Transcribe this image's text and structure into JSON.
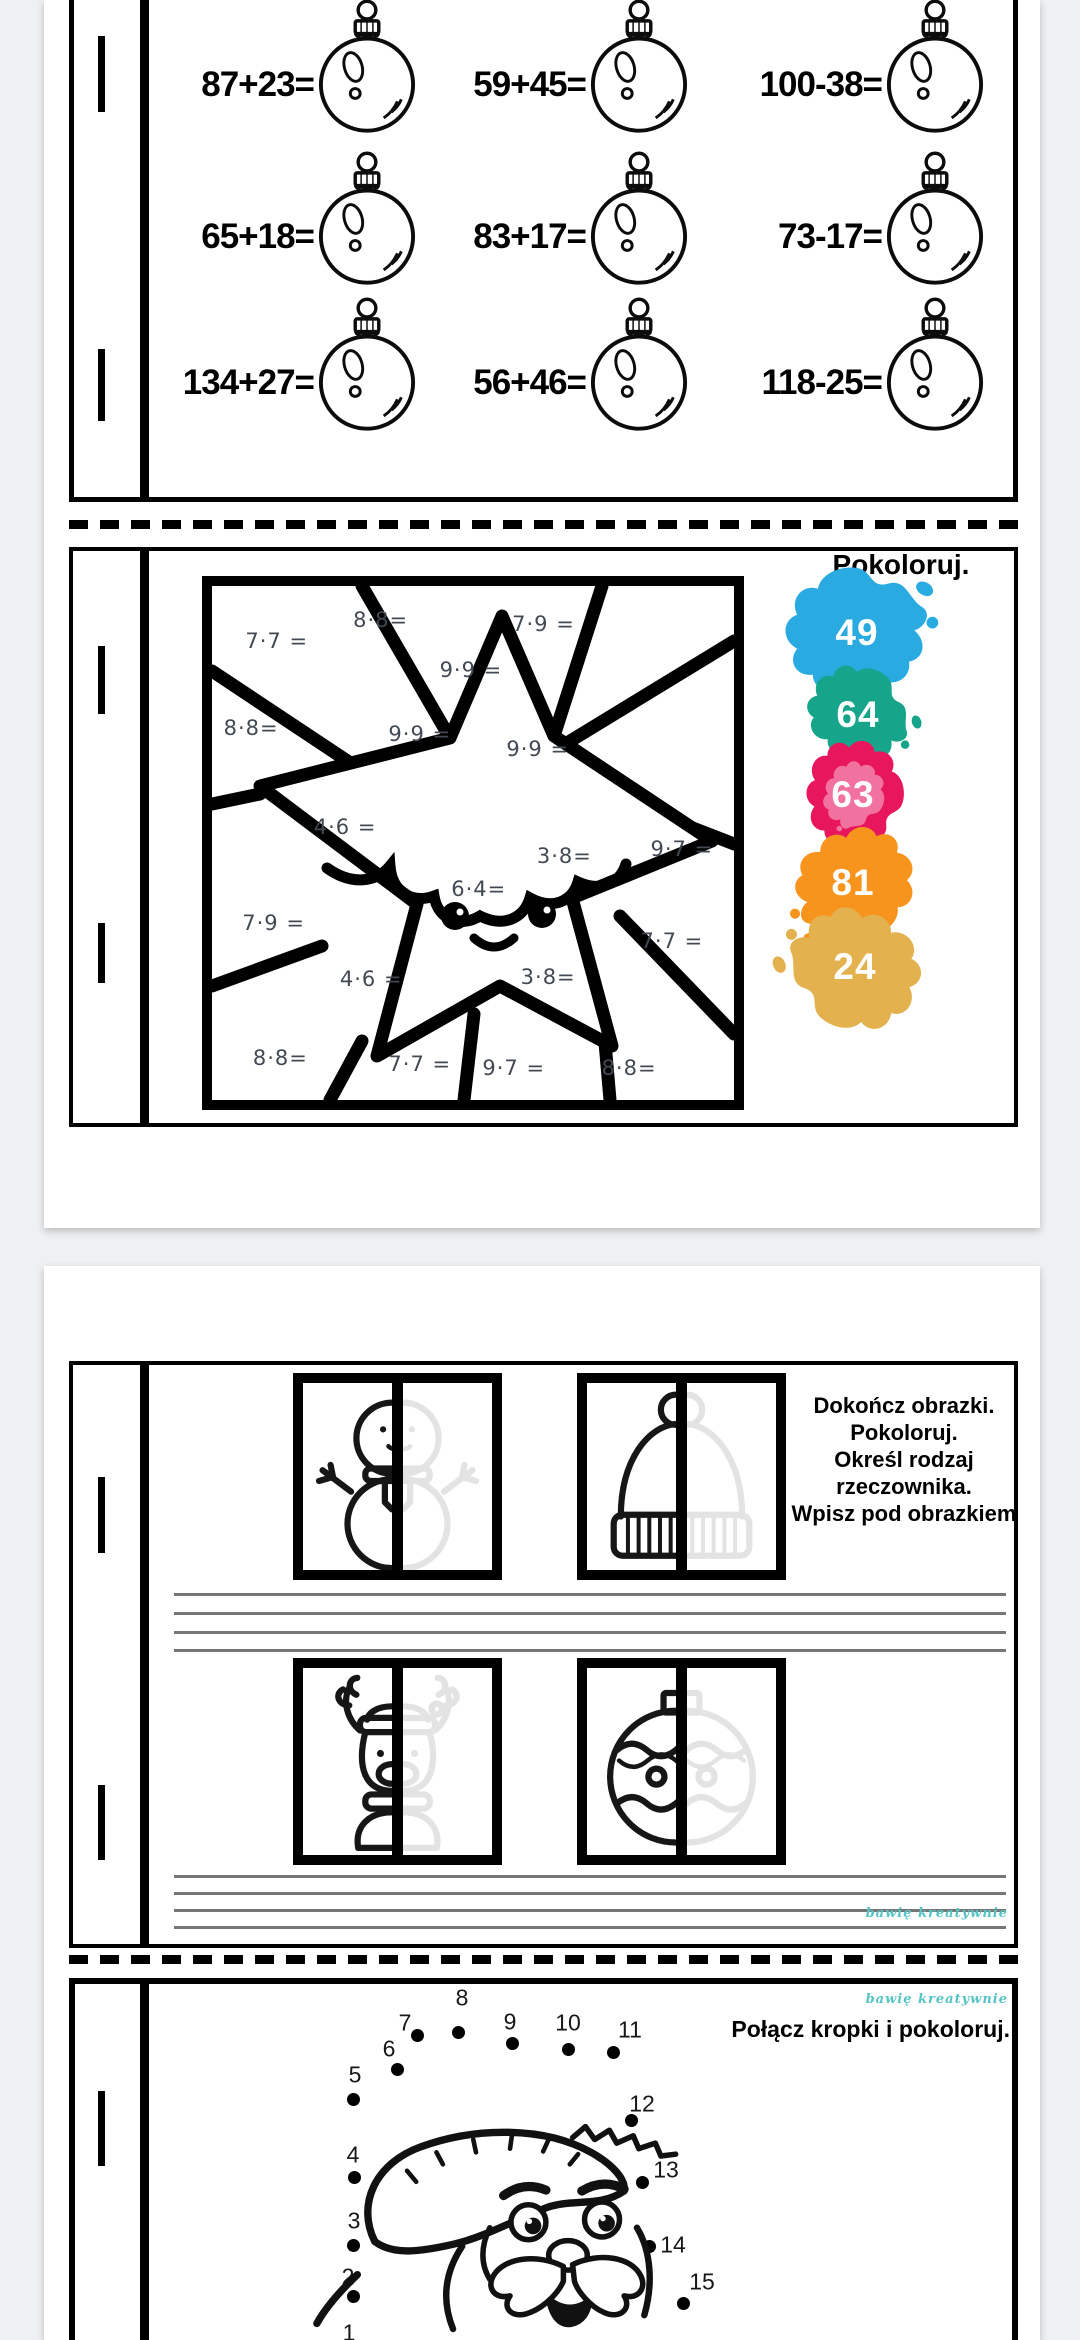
{
  "viewer": {
    "background_color": "#eef0f2",
    "page_color": "#ffffff"
  },
  "page1": {
    "math_worksheet": {
      "ornament_icon": "christmas-bauble-icon",
      "rows": [
        [
          "87+23=",
          "59+45=",
          "100-38="
        ],
        [
          "65+18=",
          "83+17=",
          "73-17="
        ],
        [
          "134+27=",
          "56+46=",
          "118-25="
        ]
      ]
    },
    "coloring_worksheet": {
      "title": "Pokoloruj.",
      "problems": [
        {
          "text": "7·7 =",
          "x": 12.4,
          "y": 10.7
        },
        {
          "text": "8·8=",
          "x": 32.3,
          "y": 6.7
        },
        {
          "text": "7·9 =",
          "x": 63.5,
          "y": 7.3
        },
        {
          "text": "9·9 =",
          "x": 49.6,
          "y": 16.4
        },
        {
          "text": "9·9 =",
          "x": 39.8,
          "y": 28.7
        },
        {
          "text": "9·9 =",
          "x": 62.4,
          "y": 31.7
        },
        {
          "text": "8·8=",
          "x": 7.5,
          "y": 27.7
        },
        {
          "text": "4·6 =",
          "x": 25.5,
          "y": 46.8
        },
        {
          "text": "3·8=",
          "x": 67.5,
          "y": 52.6
        },
        {
          "text": "9·7 =",
          "x": 90.0,
          "y": 51.2
        },
        {
          "text": "6·4=",
          "x": 51.1,
          "y": 58.9
        },
        {
          "text": "7·7 =",
          "x": 88.1,
          "y": 69.0
        },
        {
          "text": "3·8=",
          "x": 64.4,
          "y": 76.1
        },
        {
          "text": "7·9 =",
          "x": 11.8,
          "y": 65.6
        },
        {
          "text": "4·6 =",
          "x": 30.5,
          "y": 76.5
        },
        {
          "text": "8·8=",
          "x": 13.1,
          "y": 91.8
        },
        {
          "text": "7·7 =",
          "x": 39.8,
          "y": 92.9
        },
        {
          "text": "9·7 =",
          "x": 57.8,
          "y": 93.7
        },
        {
          "text": "8·8=",
          "x": 79.9,
          "y": 93.7
        }
      ],
      "splats": [
        {
          "value": "49",
          "color": "#29abe2"
        },
        {
          "value": "64",
          "color": "#16a58b"
        },
        {
          "value": "63",
          "color": "#e8175d",
          "inner_color": "#f2729f"
        },
        {
          "value": "81",
          "color": "#f7941e"
        },
        {
          "value": "24",
          "color": "#e3b14e"
        }
      ]
    }
  },
  "page2": {
    "pictures_worksheet": {
      "instructions": [
        "Dokończ obrazki.",
        "Pokoloruj.",
        "Określ rodzaj",
        "rzeczownika.",
        "Wpisz pod obrazkiem"
      ],
      "figures": [
        {
          "name": "snowman"
        },
        {
          "name": "winter-hat"
        },
        {
          "name": "reindeer"
        },
        {
          "name": "ornament-ball"
        }
      ],
      "watermark": "bawię kreatywnie"
    },
    "dots_worksheet": {
      "title": "Połącz kropki i pokoloruj.",
      "watermark": "bawię kreatywnie",
      "dots": [
        {
          "n": "1",
          "lx": 305,
          "ly": 1067,
          "dx": 309,
          "dy": 1090
        },
        {
          "n": "2",
          "lx": 304,
          "ly": 1011,
          "dx": 309,
          "dy": 1030
        },
        {
          "n": "3",
          "lx": 310,
          "ly": 955,
          "dx": 309,
          "dy": 979
        },
        {
          "n": "4",
          "lx": 309,
          "ly": 889,
          "dx": 310,
          "dy": 911
        },
        {
          "n": "5",
          "lx": 311,
          "ly": 809,
          "dx": 309,
          "dy": 833
        },
        {
          "n": "6",
          "lx": 345,
          "ly": 783,
          "dx": 353,
          "dy": 803
        },
        {
          "n": "7",
          "lx": 361,
          "ly": 757,
          "dx": 373,
          "dy": 769
        },
        {
          "n": "8",
          "lx": 418,
          "ly": 732,
          "dx": 414,
          "dy": 766
        },
        {
          "n": "9",
          "lx": 466,
          "ly": 756,
          "dx": 468,
          "dy": 777
        },
        {
          "n": "10",
          "lx": 524,
          "ly": 757,
          "dx": 524,
          "dy": 783
        },
        {
          "n": "11",
          "lx": 586,
          "ly": 764,
          "dx": 569,
          "dy": 786
        },
        {
          "n": "12",
          "lx": 598,
          "ly": 838,
          "dx": 587,
          "dy": 854
        },
        {
          "n": "13",
          "lx": 622,
          "ly": 904,
          "dx": 598,
          "dy": 916
        },
        {
          "n": "14",
          "lx": 629,
          "ly": 979,
          "dx": 605,
          "dy": 980
        },
        {
          "n": "15",
          "lx": 658,
          "ly": 1016,
          "dx": 639,
          "dy": 1037
        }
      ]
    }
  }
}
